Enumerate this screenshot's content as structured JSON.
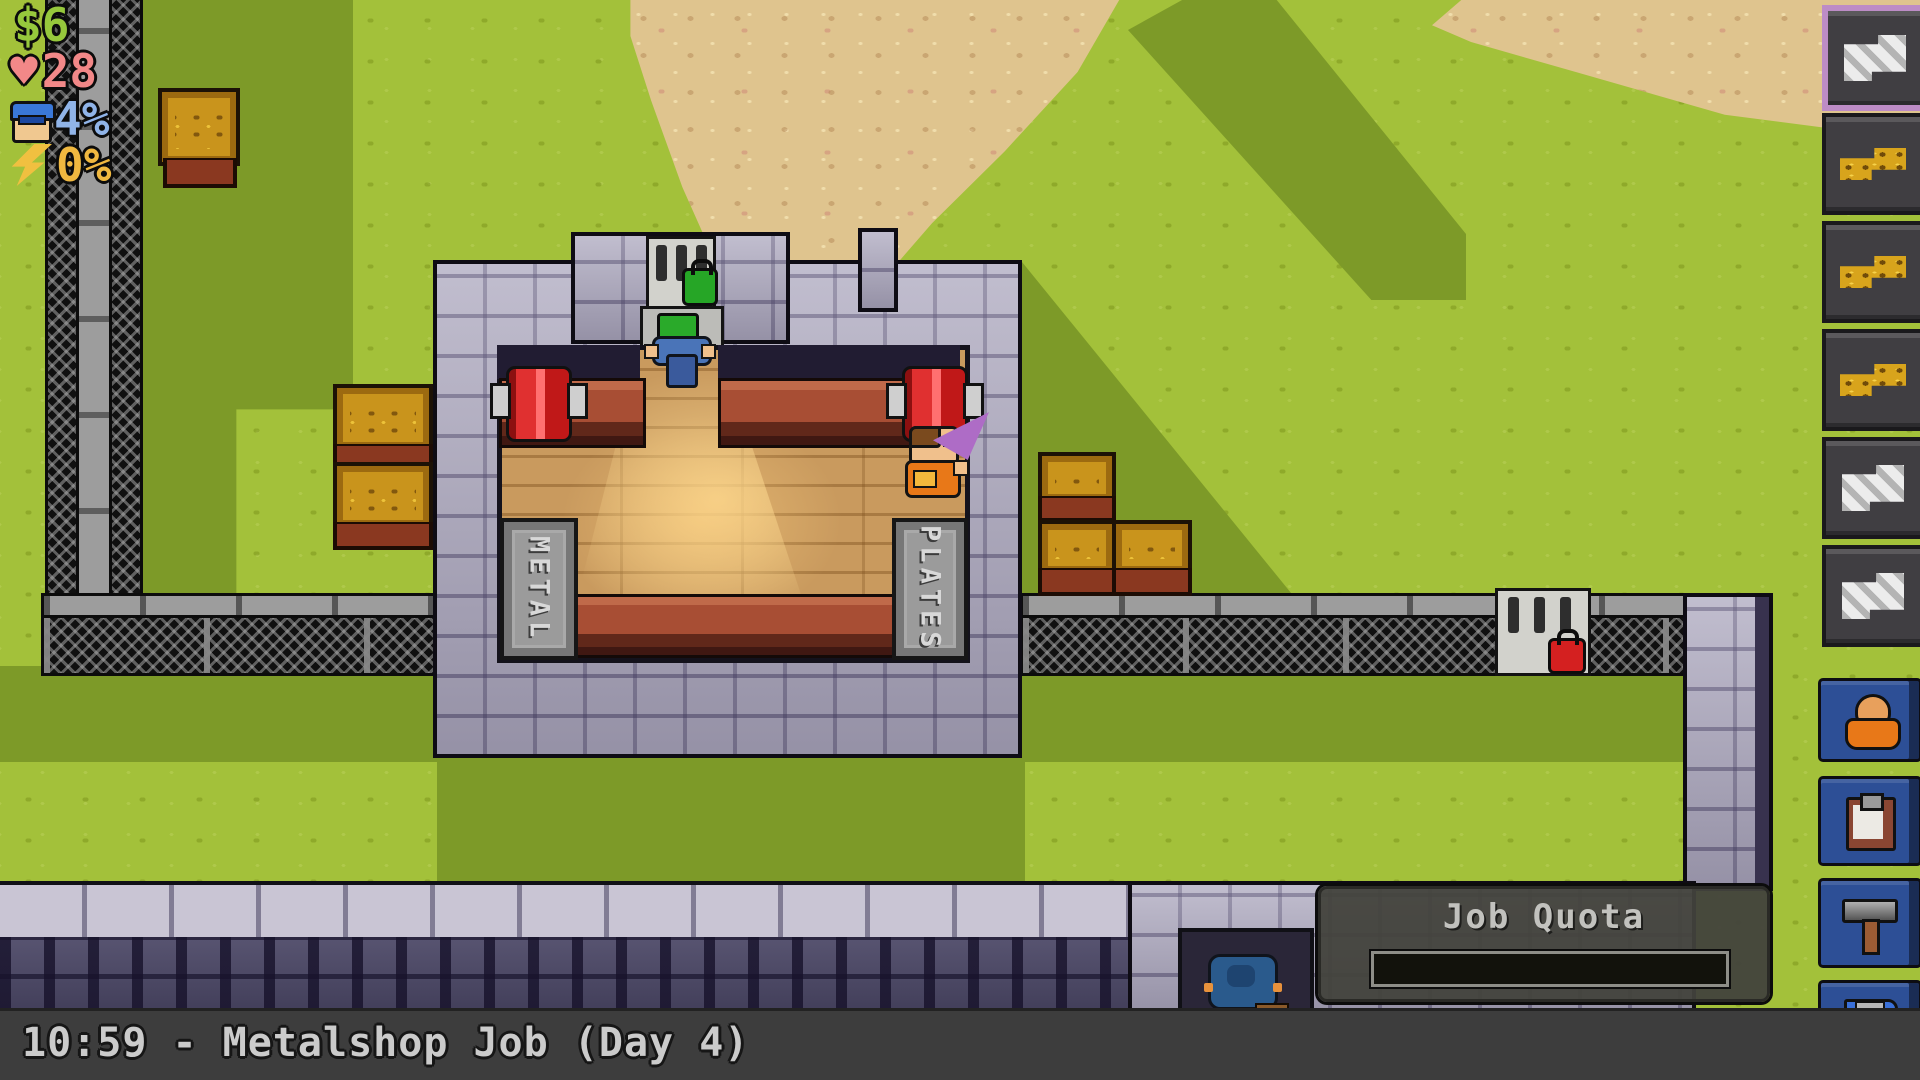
{
  "hud": {
    "money": "$6",
    "health": "28",
    "guard_heat": "4%",
    "energy": "0%"
  },
  "inventory": {
    "slots": [
      {
        "item": "metal-sheet",
        "selected": true
      },
      {
        "item": "timber",
        "selected": false
      },
      {
        "item": "timber",
        "selected": false
      },
      {
        "item": "timber",
        "selected": false
      },
      {
        "item": "metal-sheet",
        "selected": false
      },
      {
        "item": "metal-sheet",
        "selected": false
      }
    ],
    "selected_border_color": "#bd8cc6"
  },
  "action_buttons": [
    {
      "id": "prisoner",
      "icon": "prisoner-icon"
    },
    {
      "id": "job-clipboard",
      "icon": "clipboard-icon"
    },
    {
      "id": "craft",
      "icon": "hammer-icon"
    },
    {
      "id": "save",
      "icon": "floppy-disk-icon"
    }
  ],
  "job_quota": {
    "title": "Job Quota",
    "progress_percent": 0
  },
  "status_bar": {
    "text": "10:59 - Metalshop Job (Day 4)"
  },
  "map": {
    "signs": {
      "left": "METAL",
      "right": "PLATES"
    },
    "locks": {
      "top_door": "green",
      "fence_door": "red"
    }
  },
  "colors": {
    "button_blue": "#2d4f96",
    "grass": "#a3c13a",
    "shadow_green": "#7d9a28"
  }
}
